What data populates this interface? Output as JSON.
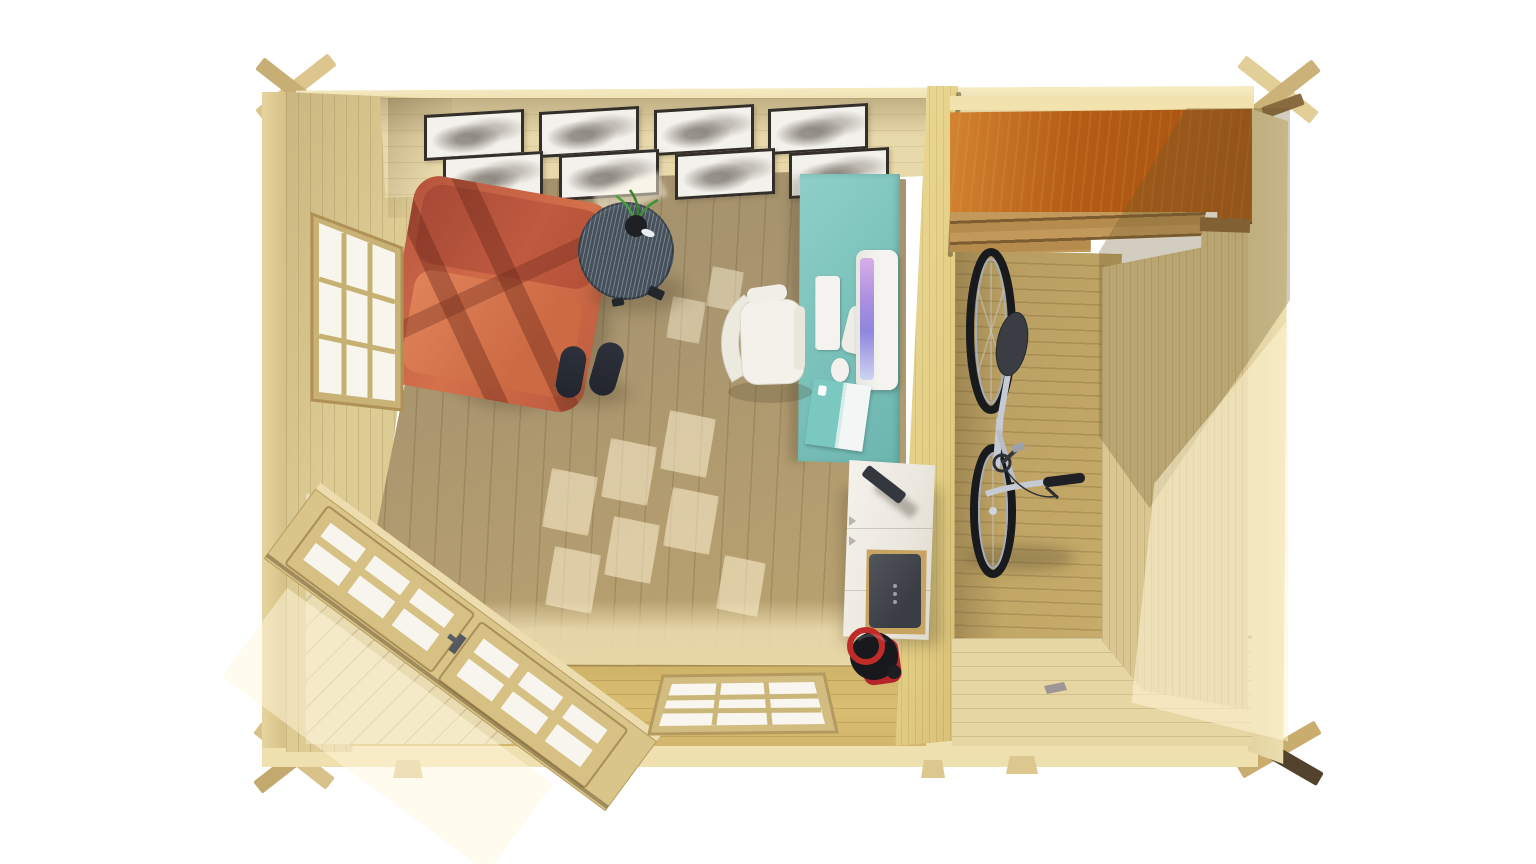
{
  "meta": {
    "kind": "3D render, top-down cutaway view",
    "subject": "Two-room wooden garden cabin: home office and bicycle storage",
    "background_color": "#ffffff",
    "visible_text": "none"
  },
  "palette": {
    "wall_wood": "#e3d3a2",
    "wall_wood_dark": "#cdb67c",
    "office_floor": "#cfc3a8",
    "storage_floor": "#ddcda0",
    "divider_wall": "#f2e7bd",
    "loft_shelf_wood": "#d69a4a",
    "desk_teal": "#7cc3bc",
    "armchair_red": "#c66245",
    "side_table_gray": "#45505b",
    "office_chair_white": "#f1efe8",
    "sideboard_white": "#eeebe3",
    "printer_gray": "#42454b",
    "kettle_red": "#bf2c28",
    "bicycle_frame_silver": "#c6cad2",
    "tire_black": "#191a1e",
    "glass_white": "#f8f5ec",
    "sunlight": "#fff3d2",
    "picture_frame_border": "#332e28"
  },
  "office_room": {
    "label": "home office room",
    "gallery_wall": {
      "frame_count": 8,
      "rows": 2,
      "art": "abstract grayscale prints"
    },
    "window_left": {
      "panes": 9,
      "grid": "3x3"
    },
    "window_bottom": {
      "panes": 9,
      "grid": "3x3"
    },
    "corner_doors": {
      "leaves": 2,
      "panes_per_leaf": 6,
      "orientation": "45-degree chamfered corner"
    },
    "items": [
      {
        "name": "armchair",
        "color": "#c66245"
      },
      {
        "name": "round-side-table",
        "color": "#45505b"
      },
      {
        "name": "potted-plant",
        "color": "#3f8f33"
      },
      {
        "name": "slippers",
        "count": 2,
        "color": "#272b34"
      },
      {
        "name": "office-chair",
        "color": "#f1efe8"
      },
      {
        "name": "desk",
        "color": "#7cc3bc"
      },
      {
        "name": "monitor",
        "color": "#f4f2ee"
      },
      {
        "name": "keyboard",
        "color": "#f5f3ef"
      },
      {
        "name": "mouse",
        "color": "#f3f1ed"
      },
      {
        "name": "magazine",
        "color": "#7bc8c1"
      },
      {
        "name": "sideboard",
        "color": "#eeebe3"
      },
      {
        "name": "stapler",
        "color": "#34373d"
      },
      {
        "name": "printer",
        "color": "#42454b"
      },
      {
        "name": "kettle",
        "color": "#bf2c28"
      }
    ]
  },
  "storage_room": {
    "label": "storage room",
    "items": [
      {
        "name": "bicycle",
        "frame_color": "#c6cad2"
      },
      {
        "name": "loft-shelf",
        "color": "#d69a4a"
      },
      {
        "name": "ceiling-rafters",
        "color": "#8a6536"
      },
      {
        "name": "floor-bracket",
        "color": "#8f8a94"
      }
    ]
  }
}
